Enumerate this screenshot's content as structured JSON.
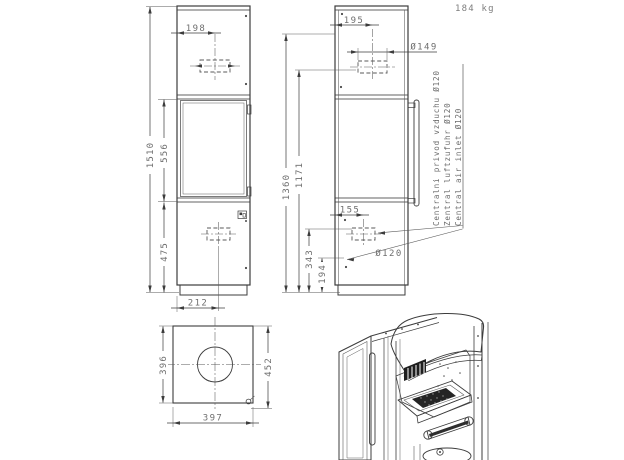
{
  "meta": {
    "weight": "184 kg"
  },
  "front_view": {
    "dims": {
      "total_height": "1510",
      "door_height": "556",
      "base_height": "475",
      "flue_offset": "198",
      "inlet_offset": "212"
    }
  },
  "side_view": {
    "dims": {
      "flue_center_offset": "195",
      "flue_diameter": "Ø149",
      "flue_height": "1360",
      "upper_height": "1171",
      "inlet_offset": "155",
      "inlet_height_a": "343",
      "inlet_height_b": "194",
      "inlet_diameter": "Ø120"
    }
  },
  "top_view": {
    "dims": {
      "depth": "396",
      "overall_depth": "452",
      "width": "397"
    }
  },
  "notes": {
    "air_inlet": [
      "Centralni privod vzduchu Ø120",
      "Zentral luftzufuhr Ø120",
      "Central air inlet Ø120"
    ]
  }
}
